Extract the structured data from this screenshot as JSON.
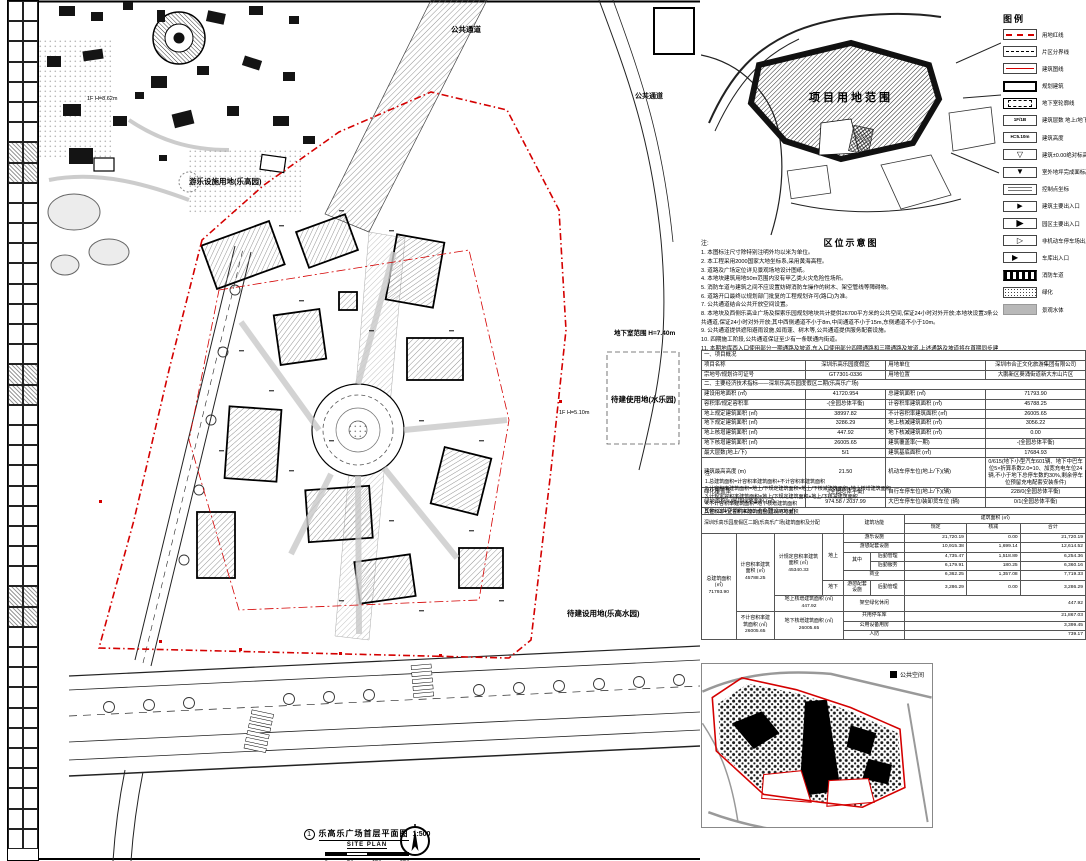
{
  "colors": {
    "red": "#d40000",
    "gray_water": "#b8b8b8"
  },
  "sheet": {
    "figure_no": "1",
    "title": "乐高乐广场首层平面图",
    "scale": "1:500",
    "subtitle": "SITE PLAN",
    "scalebar_labels": [
      "0",
      "5m",
      "10m",
      "20m"
    ]
  },
  "plan": {
    "label_park": "游乐设施用地(乐高园)",
    "label_corridor": "公共通道",
    "label_corridor2": "公共通道",
    "label_basement": "地下室范围 H=7.40m",
    "label_water": "待建使用地(水乐园)",
    "label_future": "待建设用地(乐高水园)",
    "label_height_a": "1F H=8.62m",
    "label_height_b": "1F H=5.10m"
  },
  "location_map": {
    "caption": "区位示意图",
    "site_label": "项目用地范围"
  },
  "legend": {
    "title": "图例",
    "items": [
      {
        "type": "line-red-dash",
        "label": "用地红线"
      },
      {
        "type": "line-black-dash",
        "label": "片区分界线"
      },
      {
        "type": "line-red",
        "label": "建筑图线"
      },
      {
        "type": "rect-solid",
        "label": "规划建筑"
      },
      {
        "type": "rect-dashed",
        "label": "地下室轮廓线"
      },
      {
        "type": "box-text",
        "text": "1F/1B",
        "label": "建筑层数 地上/地下"
      },
      {
        "type": "box-text",
        "text": "H=5.10m",
        "label": "建筑高度"
      },
      {
        "type": "tri-open",
        "label": "建筑±0.00绝对标高"
      },
      {
        "type": "tri-solid",
        "label": "室外地坪完成面标高"
      },
      {
        "type": "coord",
        "label": "控制点坐标"
      },
      {
        "type": "arrow-solid",
        "label": "建筑主要出入口"
      },
      {
        "type": "arrow-fat",
        "label": "园区主要出入口"
      },
      {
        "type": "arrow-open",
        "label": "非机动车停车场出入口"
      },
      {
        "type": "arrow-out",
        "label": "车库出入口"
      },
      {
        "type": "band-hatch",
        "label": "消防车道"
      },
      {
        "type": "dots",
        "label": "绿化"
      },
      {
        "type": "gray",
        "label": "景观水体"
      }
    ]
  },
  "notes": {
    "title": "注:",
    "items": [
      "1. 本图标注尺寸除特别注明外均以米为单位。",
      "2. 本工程采用2000国家大地坐标系,采用黄海高程。",
      "3. 道路及广场定位详见景观场地设计图纸。",
      "4. 本地块建筑用地50m范围内没有甲乙类火灾危险性场所。",
      "5. 消防车道与建筑之间不应设置妨碍消防车操作的树木、架空管线等障碍物。",
      "6. 道路开口最终以规划部门批复的工程规划许可(路口)为准。",
      "7. 公共通道结合公共开放空间设置。",
      "8. 本地块及西侧乐高业广场及探索乐园规划地块共计提供26700平方米的公共空间,保证24小时对外开放;本地块设置3条公共通道,保证24小时对外开放;其中西侧通道不小于8m,中间通道不小于15m,东侧通道不小于10m。",
      "9. 公共通道提供遮阳避雨设施,如雨蓬、树木等,公共通道提供服务配套设施。",
      "10. 四期施工阶段,公共通道保证至少有一条联通内街道。",
      "11. 本期地库西入口使用部分一期通路及坡道,东入口使用部分四期通路和三期通路及坡道,上述通路及坡道将在首期同步建设完成。",
      "12. 图中标注的消防设施仅为示意,应按相关专项设计另行报批。"
    ]
  },
  "tables": {
    "main": {
      "rows": [
        {
          "type": "section",
          "text": "一、项目概况"
        },
        {
          "type": "r",
          "c": [
            "项目名称",
            "深圳乐高乐园度假区",
            "用地单位",
            "深圳市合正文化旅游集团有限公司"
          ]
        },
        {
          "type": "r",
          "c": [
            "宗地号/规划许可证号",
            "GT7301-0336",
            "用地位置",
            "大鹏新区葵涌街道新大东山片区"
          ]
        },
        {
          "type": "section",
          "text": "二、主要经济技术指标——深圳乐高乐园度假区二期(乐高乐广场)"
        },
        {
          "type": "r",
          "c": [
            "建设用地面积 (㎡)",
            "41720.954",
            "总建筑面积 (㎡)",
            "71793.90"
          ]
        },
        {
          "type": "r",
          "c": [
            "容积率/规定容积率",
            "-(全园总体平衡)",
            "计容积率建筑面积 (㎡)",
            "45788.25"
          ]
        },
        {
          "type": "r",
          "c": [
            "地上规定建筑面积 (㎡)",
            "38997.82",
            "不计容积率建筑面积 (㎡)",
            "26005.65"
          ]
        },
        {
          "type": "r",
          "c": [
            "地下规定建筑面积 (㎡)",
            "3286.29",
            "地上核减建筑面积 (㎡)",
            "3056.22"
          ]
        },
        {
          "type": "r",
          "c": [
            "地上核增建筑面积 (㎡)",
            "447.92",
            "地下核减建筑面积 (㎡)",
            "0.00"
          ]
        },
        {
          "type": "r",
          "c": [
            "地下核增建筑面积 (㎡)",
            "26005.65",
            "建筑覆盖率(一期)",
            "-(全园总体平衡)"
          ]
        },
        {
          "type": "r",
          "c": [
            "最大层数(地上/下)",
            "5/1",
            "建筑基底面积 (㎡)",
            "17684.93"
          ]
        },
        {
          "type": "r",
          "c": [
            "建筑最高高度 (m)",
            "21.50",
            "机动车停车位(地上/下)(辆)",
            "0/615(地下小型汽车601辆、地下中巴车位5×折算系数2.0=10、加宽充电车位24辆,不小于地下总停车数的30%,剩余停车位预留充电配套安装条件)"
          ]
        },
        {
          "type": "r",
          "c": [
            "绿化覆盖率",
            "-(全园总体平衡)",
            "自行车停车位(地上/下)(辆)",
            "228/0(全园总体平衡)"
          ]
        },
        {
          "type": "r",
          "c": [
            "绿地面积%/屋顶绿地面积 (㎡)",
            "974.58 / 2037.99",
            "大巴车停车位/装卸货车位 (辆)",
            "0/1(全园总体平衡)"
          ]
        },
        {
          "type": "wide",
          "text": "其他:公共空间约4200㎡(全园26700㎡)"
        }
      ],
      "notes_title": "注:",
      "notes": [
        "1.总建筑面积=计容积率建筑面积+不计容积率建筑面积",
        "2.计容积率建筑面积=地上/下规定建筑面积+地上/下核减建筑面积+地上核增建筑面积",
        "3.计规定容积率建筑面积=地上/下规定建筑面积+地上/下核减建筑面积",
        "4.不计容积率建筑面积=地下核增建筑面积",
        "5.容积率=计容积率建筑面积/建设用地面积",
        "6.规定容积率=计规定容积率建筑面积/建设用地面积"
      ]
    },
    "area": {
      "title": "深圳乐高乐园度假区二期(乐高乐广场)建筑面积及分配",
      "h_function": "建筑功能",
      "h_area": "建筑面积 (㎡)",
      "h_cols": [
        "规定",
        "核减",
        "合计"
      ],
      "total_label": "总建筑面积 (㎡)",
      "total": "71793.90",
      "far_label": "计容积率建筑面积 (㎡)",
      "far": "45788.25",
      "far_reg_label": "计规定容积率建筑面积 (㎡)",
      "far_reg": "45340.33",
      "above": "地上",
      "below": "地下",
      "rows_above": [
        {
          "fn": "游乐设施",
          "reg": "21,720.19",
          "ded": "0.00",
          "tot": "21,720.19"
        },
        {
          "fn": "游憩配套设施",
          "reg": "10,915.38",
          "ded": "1,699.14",
          "tot": "12,614.52"
        },
        {
          "fn1": "其中",
          "fn2": "后勤管理",
          "reg": "4,735.47",
          "ded": "1,518.89",
          "tot": "6,254.36"
        },
        {
          "fn2": "后勤服务",
          "reg": "6,179.91",
          "ded": "180.25",
          "tot": "6,360.16"
        },
        {
          "fn": "商业",
          "reg": "6,362.25",
          "ded": "1,357.08",
          "tot": "7,719.33"
        }
      ],
      "row_below": {
        "fn1": "游憩配套设施",
        "fn2": "后勤管理",
        "reg": "3,286.29",
        "ded": "0.00",
        "tot": "3,286.29"
      },
      "bonus_above_label": "地上核增建筑面积 (㎡)",
      "bonus_above": "447.92",
      "bonus_above_fn": "架空绿化休闲",
      "bonus_above_tot": "447.92",
      "nofar_label": "不计容积率建筑面积 (㎡)",
      "nofar": "26005.65",
      "bonus_below_label": "地下核增建筑面积 (㎡)",
      "bonus_below": "26005.65",
      "rows_nofar": [
        {
          "fn": "共用停车库",
          "tot": "21,867.03"
        },
        {
          "fn": "公用设备用房",
          "tot": "3,399.45"
        },
        {
          "fn": "人防",
          "tot": "739.17"
        }
      ]
    }
  },
  "mini_map": {
    "legend_label": "公共空间"
  }
}
